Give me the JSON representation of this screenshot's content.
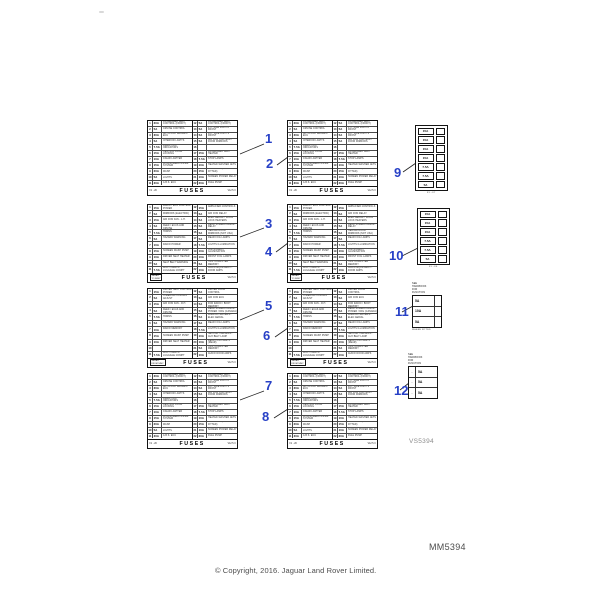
{
  "colors": {
    "callout_blue": "#2740c6",
    "leader_line": "#222222"
  },
  "page_codes": {
    "diagram_code": "VS5394",
    "figure_code": "MM5394"
  },
  "copyright": "© Copyright, 2016. Jaguar Land Rover Limited.",
  "callouts": [
    {
      "label": "1"
    },
    {
      "label": "2"
    },
    {
      "label": "3"
    },
    {
      "label": "4"
    },
    {
      "label": "5"
    },
    {
      "label": "6"
    },
    {
      "label": "7"
    },
    {
      "label": "8"
    },
    {
      "label": "9"
    },
    {
      "label": "10"
    },
    {
      "label": "11"
    },
    {
      "label": "12"
    }
  ],
  "rowsets": {
    "A": {
      "left": [
        [
          "1",
          "30A",
          "PASSENGER SEAT CONTROL (FRONT)"
        ],
        [
          "2",
          "5A",
          "CRUISE CONTROL"
        ],
        [
          "3",
          "30A",
          "ANTI-LOCK BRAKES / ECU"
        ],
        [
          "4",
          "5A",
          "INTERIOR LIGHTS"
        ],
        [
          "5",
          "7.5A",
          "DIRECTION INDICATORS"
        ],
        [
          "6",
          "15A",
          "CENTRAL DOOR LOCKING"
        ],
        [
          "7",
          "10A",
          "CIGAR LIGHTER"
        ],
        [
          "8",
          "15A",
          "WINDSCREEN WIPER SYSTEM"
        ],
        [
          "9",
          "20A",
          "HEADLAMP POWER WASH"
        ],
        [
          "10",
          "5A",
          "COURTESY MIRROR LIGHTS"
        ],
        [
          "11",
          "30A",
          "A.B.S. ECU"
        ]
      ],
      "right": [
        [
          "12",
          "5A",
          "PASSENGER SEAT CONTROL (FRONT)"
        ],
        [
          "13",
          "5A",
          "L.H. SIDE LIGHTS FRONT"
        ],
        [
          "14",
          "5A",
          "R.H. SIDE LIGHTS FRONT"
        ],
        [
          "15",
          "5A",
          "AIR CON CONTROL / DOOR MIRRORS"
        ],
        [
          "16",
          "",
          ""
        ],
        [
          "17",
          "15A",
          "PASSENGER SEAT HEATER"
        ],
        [
          "18",
          "7.5A",
          "STOP LAMPS"
        ],
        [
          "19",
          "10A",
          "HEATED WASHER JETS"
        ],
        [
          "20",
          "15A",
          "SUN ROOF (WHERE FITTED)"
        ],
        [
          "21",
          "10A",
          "SCREEN POWER RELAY"
        ],
        [
          "22",
          "20A",
          "FUEL PUMP"
        ]
      ]
    },
    "B": {
      "left": [
        [
          "1",
          "15A",
          "RADIO / ECU CONTROL POWER"
        ],
        [
          "2",
          "5A",
          "MIRRORS (ELECTRIC)"
        ],
        [
          "3",
          "15A",
          "AIR CON FAN - L.H."
        ],
        [
          "4",
          "5A",
          "RADIO TELEPHONE IGN FEED / ECUS AND CRUISE"
        ],
        [
          "5",
          "7.5A",
          "HORNS"
        ],
        [
          "6",
          "5A",
          "HAZARD WARNING"
        ],
        [
          "7",
          "10A",
          "RADIO POWER"
        ],
        [
          "8",
          "15A",
          "SCREEN WASH PUMP"
        ],
        [
          "9",
          "10A",
          "DRIVER SEAT HEATER"
        ],
        [
          "10",
          "5A",
          "SEAT BELT WARNING"
        ],
        [
          "11",
          "7.5A",
          "BOOT LAMPS / LUGGAGE COMPT"
        ]
      ],
      "right": [
        [
          "12",
          "15A",
          "AMPLIFIER CONTROLS"
        ],
        [
          "13",
          "5A",
          "AIR CON RELAY"
        ],
        [
          "14",
          "5A",
          "ELEC AERIAL / DOOR LOCK HEATERS"
        ],
        [
          "15",
          "5A",
          "REAR SCREEN DEMIST RELAY"
        ],
        [
          "16",
          "5A",
          "HEATED DOOR MIRRORS (NOT USA)"
        ],
        [
          "17",
          "5A",
          "REAR FOG LAMPS"
        ],
        [
          "18",
          "7.5A",
          "LIGHTS ILLUMINATION"
        ],
        [
          "19",
          "10A",
          "INSTRUMENT ILLUMINATION"
        ],
        [
          "20",
          "10A",
          "FRONT FOG LAMPS"
        ],
        [
          "21",
          "5A",
          "TRIP COMPUTER MEMORY"
        ],
        [
          "22",
          "10A",
          "AUDIO EQUIPMENT / DOOR AMPS"
        ]
      ]
    },
    "C": {
      "left": [
        [
          "1",
          "15A",
          "DRIVER SEAT CONTROL POWER"
        ],
        [
          "2",
          "5A",
          "STEERING COLUMN ADJUST"
        ],
        [
          "3",
          "15A",
          "AIR CON FAN - R.H."
        ],
        [
          "4",
          "5A",
          "RADIO TELEPHONE IGN FEED / ECAS AND CRUISE"
        ],
        [
          "5",
          "7.5A",
          "HORNS"
        ],
        [
          "6",
          "5A",
          "HAZARD WARNING"
        ],
        [
          "7",
          "10A",
          "RADIO MEMORY"
        ],
        [
          "8",
          "15A",
          "SCREEN WASH PUMP"
        ],
        [
          "9",
          "10A",
          "DRIVER SEAT HEATER"
        ],
        [
          "10",
          "",
          ""
        ],
        [
          "11",
          "7.5A",
          "BOOT LAMPS / LUGGAGE COMPT"
        ]
      ],
      "right": [
        [
          "12",
          "5A",
          "DRIVER DOOR CONTROL"
        ],
        [
          "13",
          "5A",
          "AIR CON ECU"
        ],
        [
          "14",
          "5A",
          "LCD HARNESS LOOM FOR RADIO / BOOT MEMORY"
        ],
        [
          "15",
          "5A",
          "REAR SCREEN DEMIST POWER / DRL (CANADA)"
        ],
        [
          "16",
          "5A",
          "MIRROR HEATERS / ELEC AERIAL"
        ],
        [
          "17",
          "5A",
          "REAR FOG LAMPS"
        ],
        [
          "18",
          "7.5A",
          "LIGHTS ILLUMINATION"
        ],
        [
          "19",
          "10A",
          "SECOND HARNESS / AUX BELT LAMP"
        ],
        [
          "20",
          "10A",
          "REAR FOG LAMPS (REAR)"
        ],
        [
          "21",
          "5A",
          "TRIP COMPUTER MEMORY"
        ],
        [
          "22",
          "10A",
          "AUDIO DOOR AMPS"
        ]
      ]
    }
  },
  "fuse_tables": [
    {
      "id": 1,
      "rowset": "A",
      "footer": {
        "left": "F1 - 20",
        "center": "FUSES",
        "right": "V12 5.3"
      }
    },
    {
      "id": 2,
      "rowset": "A",
      "footer": {
        "left": "F1 - 20",
        "center": "FUSES",
        "right": "V12 5.3"
      }
    },
    {
      "id": 3,
      "rowset": "B",
      "footer": {
        "box": [
          "SEDAN",
          "TO 94MY"
        ],
        "center": "FUSES",
        "right": "V12 5.3"
      }
    },
    {
      "id": 4,
      "rowset": "B",
      "footer": {
        "box": [
          "SEDAN",
          "TO 94MY"
        ],
        "center": "FUSES",
        "right": "V12 5.3"
      }
    },
    {
      "id": 5,
      "rowset": "C",
      "footer": {
        "box": [
          "SEDAN",
          "FROM 94MY"
        ],
        "center": "FUSES",
        "right": "V12 5.3"
      }
    },
    {
      "id": 6,
      "rowset": "C",
      "footer": {
        "box": [
          "SEDAN",
          "FROM 94MY"
        ],
        "center": "FUSES",
        "right": "V12 5.3"
      }
    },
    {
      "id": 7,
      "rowset": "A",
      "footer": {
        "left": "F1 - 20",
        "center": "FUSES",
        "right": "V12 5.3"
      }
    },
    {
      "id": 8,
      "rowset": "A",
      "footer": {
        "left": "F1 - 20",
        "center": "FUSES",
        "right": "V12 5.3"
      }
    }
  ],
  "strip_tables": [
    {
      "id": 9,
      "amps": [
        "15A",
        "15A",
        "15A",
        "15A",
        "7.5A",
        "7.5A",
        "5A"
      ],
      "caption": "F1 - F7"
    },
    {
      "id": 10,
      "amps": [
        "15A",
        "15A",
        "15A",
        "7.5A",
        "7.5A",
        "5A"
      ],
      "caption": "F1 - F6"
    }
  ],
  "mini_tables": [
    {
      "id": 11,
      "header_lines": [
        "SEE",
        "HANDBOOK",
        "FOR",
        "FUNCTION"
      ],
      "rows": [
        {
          "pre": "",
          "amp": "5A"
        },
        {
          "pre": "",
          "amp": "10A"
        },
        {
          "pre": "",
          "amp": "5A"
        }
      ],
      "caption": "WHERE FITTED"
    },
    {
      "id": 12,
      "header_lines": [
        "SEE",
        "HANDBOOK",
        "FOR",
        "FUNCTION"
      ],
      "rows": [
        {
          "pre": "-",
          "amp": "5A"
        },
        {
          "pre": "-",
          "amp": "5A"
        },
        {
          "pre": "-",
          "amp": "5A"
        }
      ],
      "caption": ""
    }
  ]
}
